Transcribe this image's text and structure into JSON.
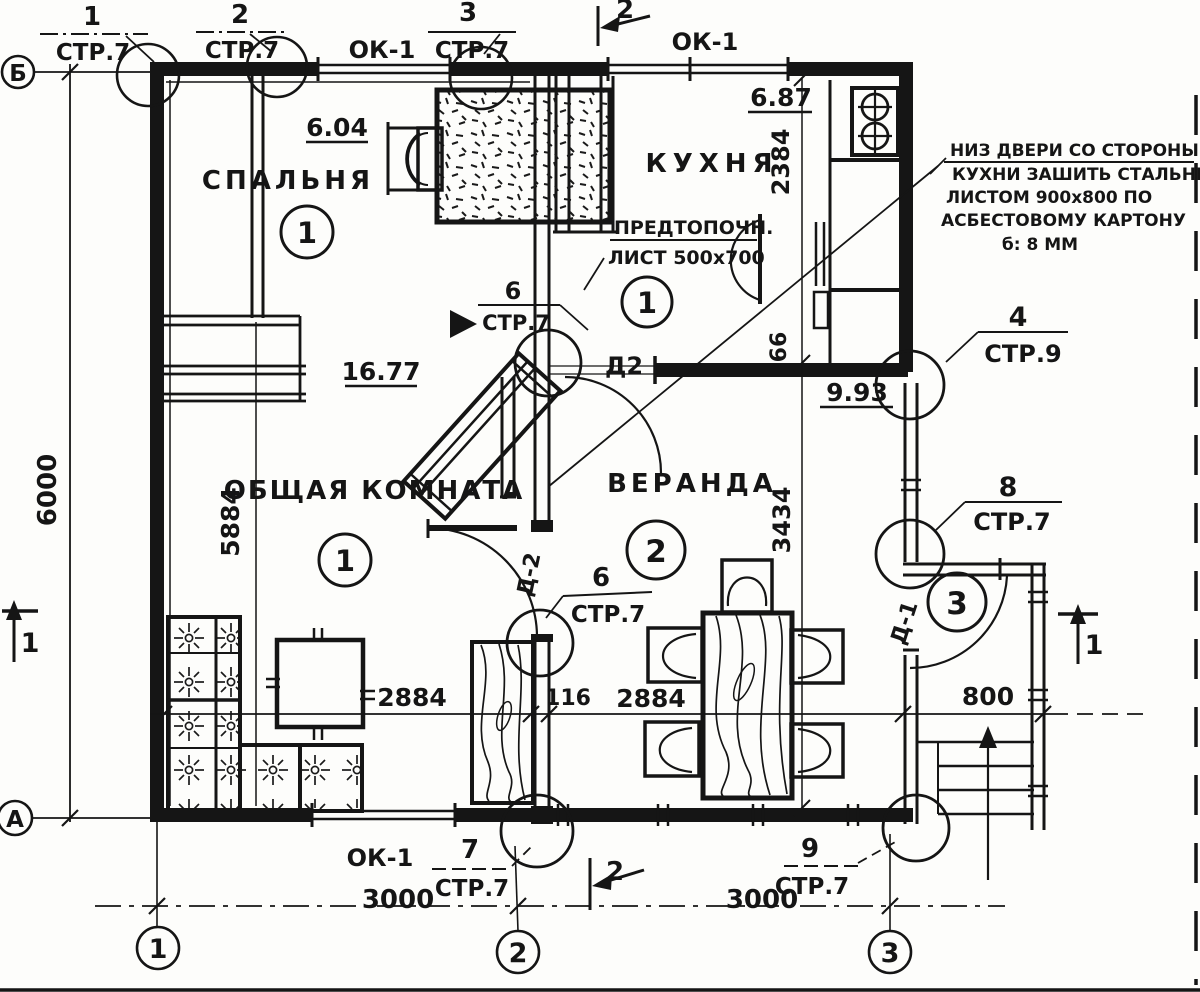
{
  "axes": {
    "b": "Б",
    "a": "А",
    "c1": "1",
    "c2": "2",
    "c3": "3"
  },
  "rooms": {
    "bedroom": {
      "name": "СПАЛЬНЯ",
      "area": "6.04",
      "number": "1"
    },
    "kitchen": {
      "name": "КУХНЯ",
      "area": "6.87",
      "number": "1"
    },
    "living": {
      "name": "ОБЩАЯ КОМНАТА",
      "area": "16.77",
      "number": "1"
    },
    "veranda": {
      "name": "ВЕРАНДА",
      "area": "9.93",
      "number": "2"
    },
    "entry": {
      "number": "3"
    }
  },
  "windows": {
    "label": "ОК-1"
  },
  "doors": {
    "d2_plain": "Д2",
    "d2": "Д-2",
    "d1": "Д-1"
  },
  "dims": {
    "total_height": "6000",
    "inner_height": "5884",
    "kitchen_depth": "2384",
    "wall_66": "66",
    "veranda_depth": "3434",
    "span_left": "2884",
    "wall_116": "116",
    "span_right": "2884",
    "porch_width": "800",
    "bay_left": "3000",
    "bay_right": "3000"
  },
  "callouts": {
    "c1": {
      "num": "1",
      "ref": "СТР.7"
    },
    "c2": {
      "num": "2",
      "ref": "СТР.7"
    },
    "c3": {
      "num": "3",
      "ref": "СТР.7"
    },
    "c4": {
      "num": "4",
      "ref": "СТР.9"
    },
    "c6_stove": {
      "num": "6",
      "ref": "СТР.7"
    },
    "c6_door": {
      "num": "6",
      "ref": "СТР.7"
    },
    "c7": {
      "num": "7",
      "ref": "СТР.7"
    },
    "c8": {
      "num": "8",
      "ref": "СТР.7"
    },
    "c9": {
      "num": "9",
      "ref": "СТР.7"
    }
  },
  "sections": {
    "s1": "1",
    "s2": "2"
  },
  "notes": {
    "fire_sheet_1": "ПРЕДТОПОЧН.",
    "fire_sheet_2": "ЛИСТ 500х700",
    "door_note_1": "НИЗ ДВЕРИ СО СТОРОНЫ",
    "door_note_2": "КУХНИ ЗАШИТЬ СТАЛЬНЫМ",
    "door_note_3": "ЛИСТОМ 900х800 ПО",
    "door_note_4": "АСБЕСТОВОМУ КАРТОНУ",
    "door_note_5": "б: 8 ММ"
  }
}
